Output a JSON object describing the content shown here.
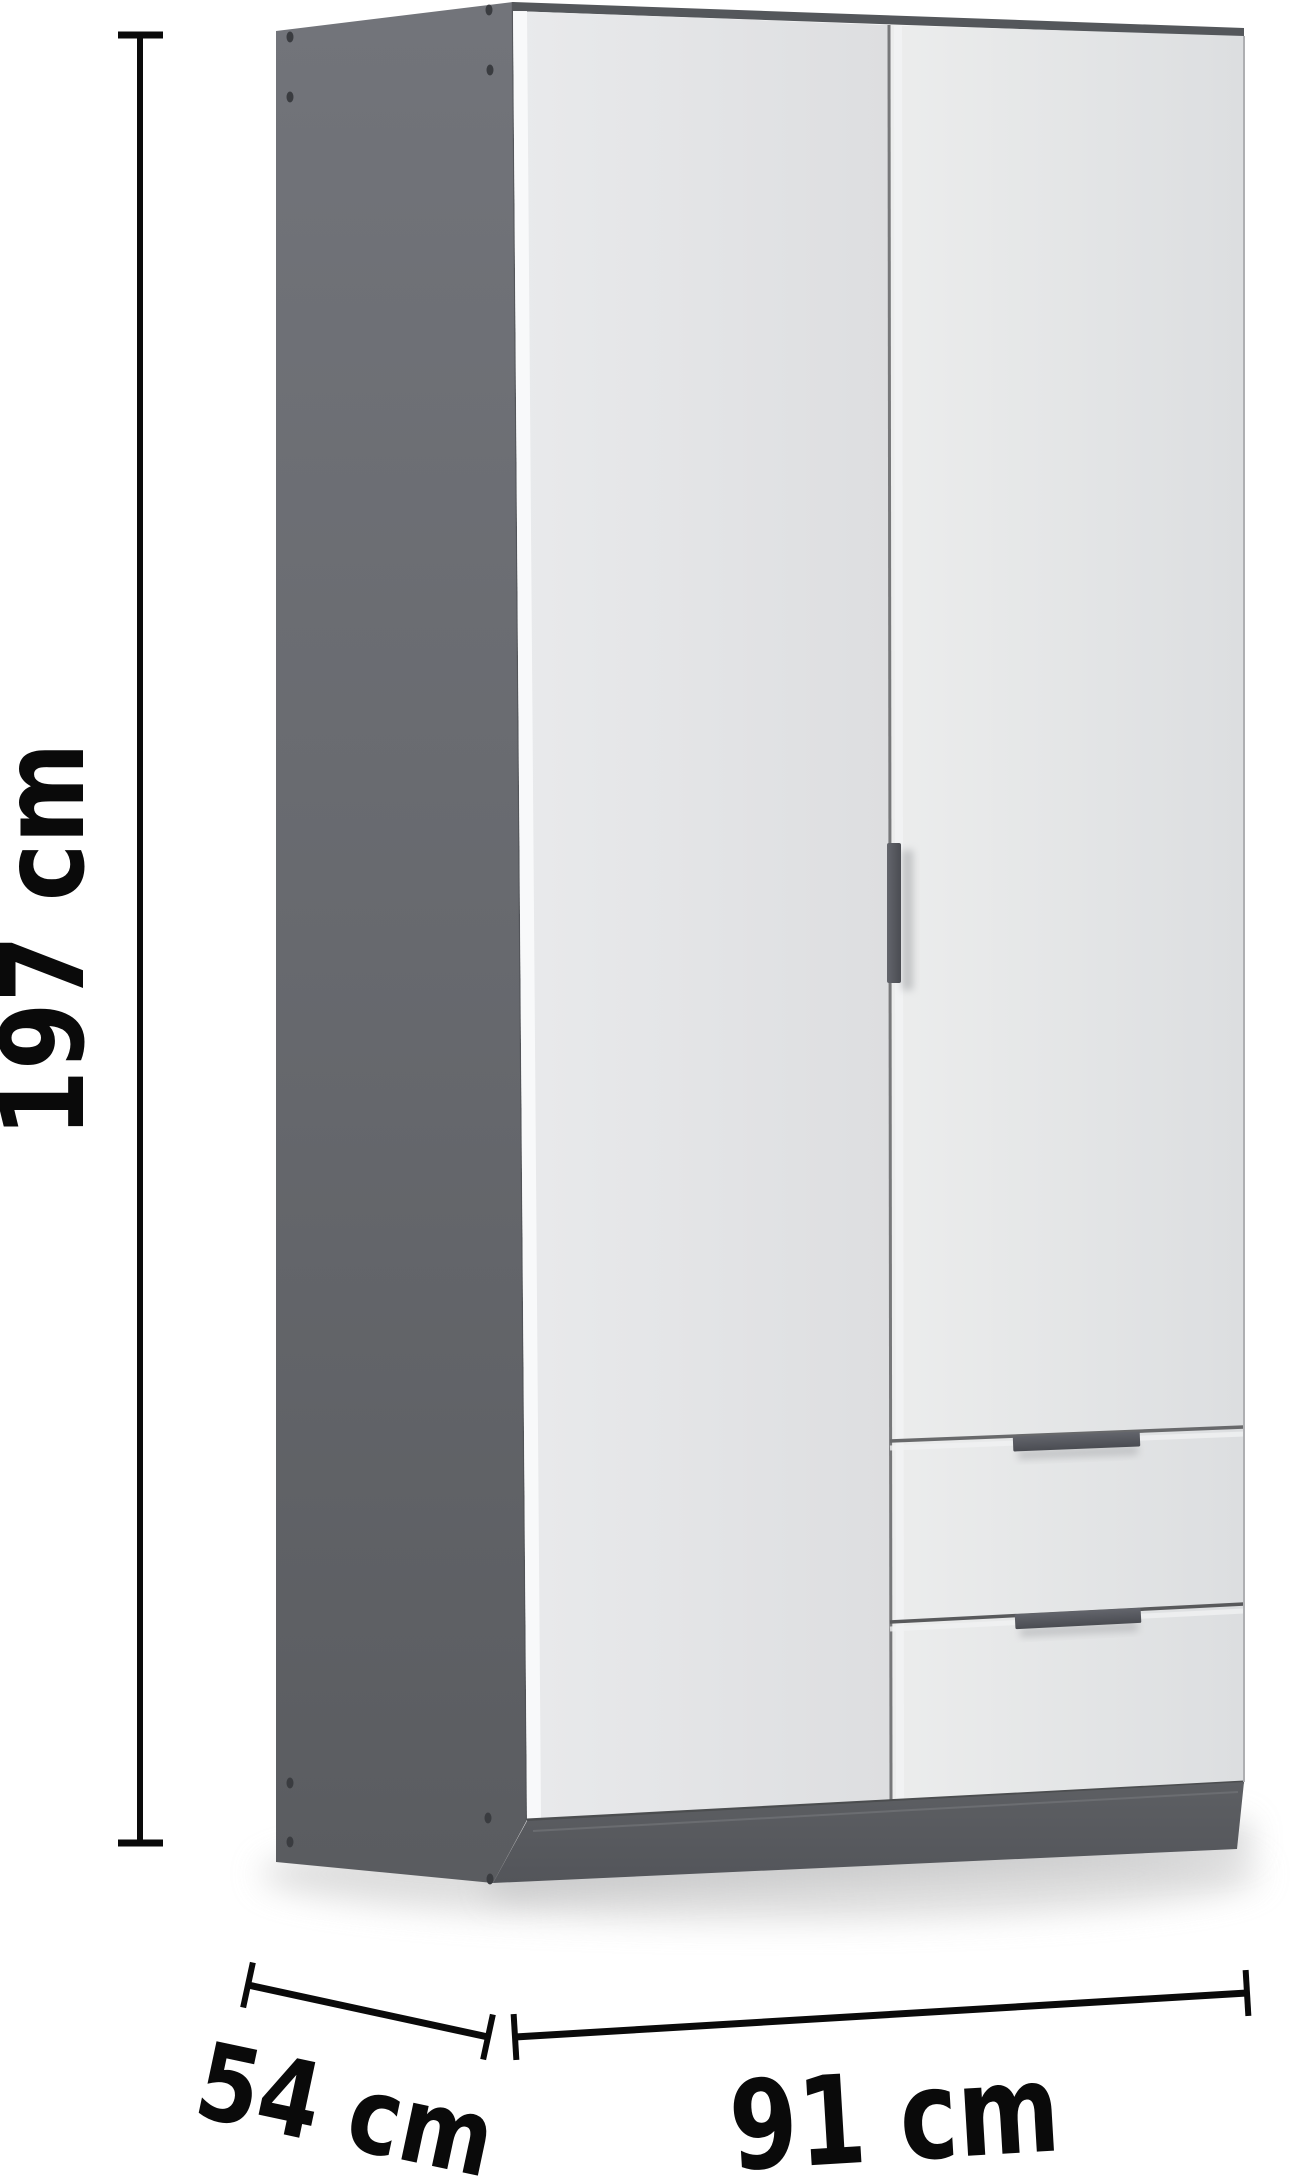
{
  "page": {
    "type": "product-dimension-diagram",
    "product": "Two-door wardrobe with two drawers",
    "view": "three-quarter front-left"
  },
  "dimensions": {
    "height": {
      "label": "197 cm"
    },
    "depth": {
      "label": "54 cm"
    },
    "width": {
      "label": "91 cm"
    }
  },
  "colors": {
    "background": "#ffffff",
    "dimension_ink": "#0a0a0a",
    "side_panel_top": "#72747a",
    "side_panel_bottom": "#5a5c60",
    "side_panel_edge": "#4e5054",
    "top_panel_edge": "#54575b",
    "door_face_light": "#eceded",
    "door_face_dark": "#dddee0",
    "door_edge_highlight": "#fafbfc",
    "gap_line": "#68696b",
    "plinth_top": "#5d5f63",
    "plinth_bottom": "#53555a",
    "plinth_highlight": "#6e7074",
    "handle_light": "#63656c",
    "handle_dark": "#4a4c52",
    "screw_hole": "#3a3c40",
    "floor_shadow": "#d2d2d2"
  }
}
